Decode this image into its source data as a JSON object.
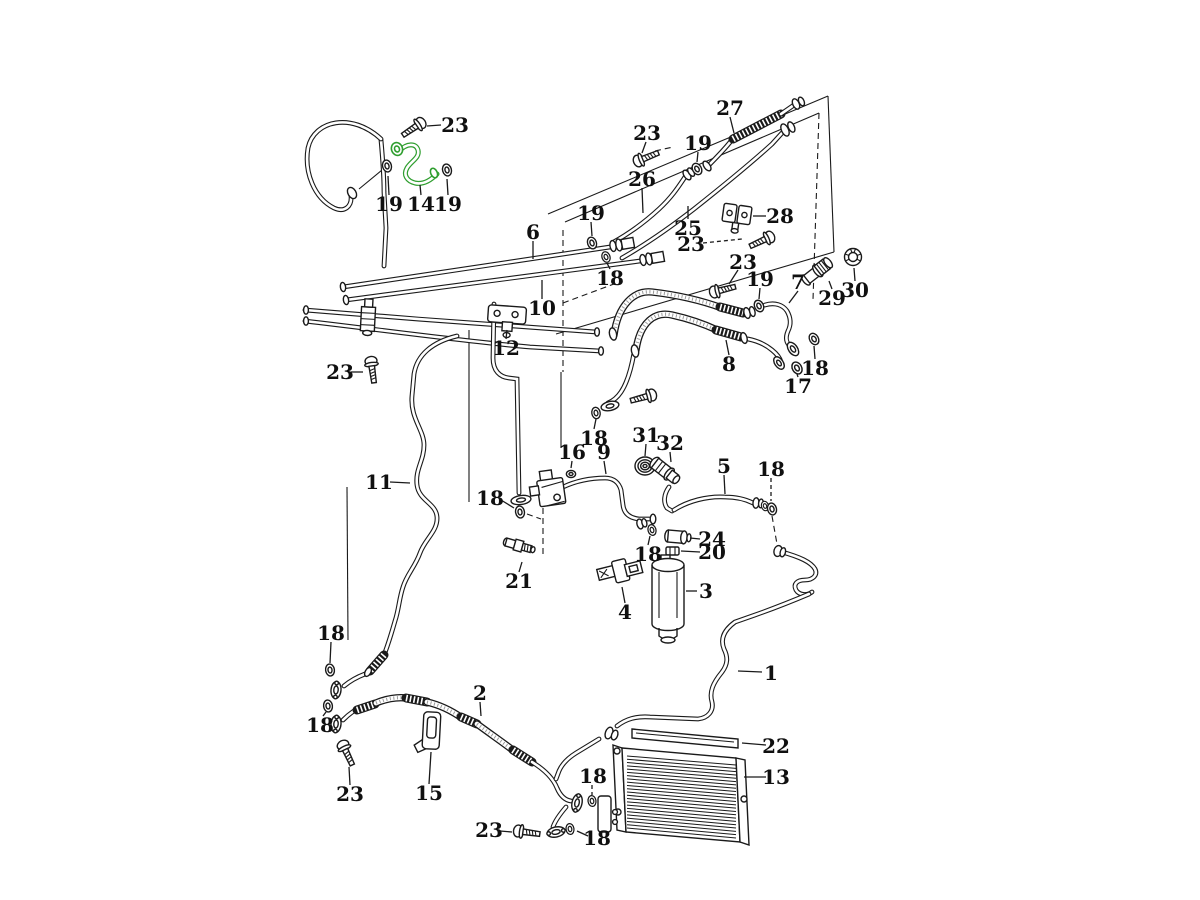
{
  "diagram": {
    "type": "exploded-parts-diagram",
    "subject": "air-conditioning-lines-and-condenser",
    "colors": {
      "background": "#ffffff",
      "line": "#1a1a1a",
      "highlight": "#2f9e2f"
    },
    "highlighted_part_number": "14",
    "condenser_fins": 23,
    "part_numbers_visible": [
      "1",
      "2",
      "3",
      "4",
      "5",
      "6",
      "7",
      "8",
      "9",
      "10",
      "11",
      "12",
      "13",
      "14",
      "15",
      "16",
      "17",
      "18",
      "19",
      "20",
      "21",
      "22",
      "23",
      "24",
      "25",
      "26",
      "27",
      "28",
      "29",
      "30",
      "31",
      "32"
    ],
    "part_labels": [
      {
        "text": "23",
        "x": 455,
        "y": 125,
        "leader": {
          "x1": 441,
          "y1": 125,
          "x2": 427,
          "y2": 126
        }
      },
      {
        "text": "19",
        "x": 389,
        "y": 204,
        "leader": {
          "x1": 389,
          "y1": 195,
          "x2": 388,
          "y2": 176
        }
      },
      {
        "text": "14",
        "x": 421,
        "y": 204,
        "leader": {
          "x1": 421,
          "y1": 195,
          "x2": 420,
          "y2": 185
        }
      },
      {
        "text": "19",
        "x": 448,
        "y": 204,
        "leader": {
          "x1": 448,
          "y1": 195,
          "x2": 447,
          "y2": 179
        }
      },
      {
        "text": "27",
        "x": 730,
        "y": 108,
        "leader": {
          "x1": 730,
          "y1": 117,
          "x2": 734,
          "y2": 133
        }
      },
      {
        "text": "23",
        "x": 647,
        "y": 133,
        "leader": {
          "x1": 646,
          "y1": 142,
          "x2": 642,
          "y2": 153
        }
      },
      {
        "text": "19",
        "x": 698,
        "y": 143,
        "leader": {
          "x1": 698,
          "y1": 152,
          "x2": 697,
          "y2": 162
        }
      },
      {
        "text": "26",
        "x": 642,
        "y": 179,
        "leader": {
          "x1": 642,
          "y1": 188,
          "x2": 643,
          "y2": 213
        }
      },
      {
        "text": "6",
        "x": 533,
        "y": 232,
        "leader": {
          "x1": 533,
          "y1": 241,
          "x2": 533,
          "y2": 259
        }
      },
      {
        "text": "25",
        "x": 688,
        "y": 228,
        "leader": {
          "x1": 688,
          "y1": 219,
          "x2": 688,
          "y2": 206
        }
      },
      {
        "text": "28",
        "x": 780,
        "y": 216,
        "leader": {
          "x1": 766,
          "y1": 216,
          "x2": 753,
          "y2": 216
        }
      },
      {
        "text": "19",
        "x": 591,
        "y": 213,
        "leader": {
          "x1": 591,
          "y1": 222,
          "x2": 592,
          "y2": 236
        }
      },
      {
        "text": "18",
        "x": 610,
        "y": 278,
        "leader": {
          "x1": 610,
          "y1": 269,
          "x2": 607,
          "y2": 263
        }
      },
      {
        "text": "23",
        "x": 691,
        "y": 244,
        "dash": true,
        "leader": {
          "x1": 703,
          "y1": 243,
          "x2": 742,
          "y2": 239
        }
      },
      {
        "text": "10",
        "x": 542,
        "y": 308,
        "leader": {
          "x1": 542,
          "y1": 299,
          "x2": 542,
          "y2": 280
        }
      },
      {
        "text": "12",
        "x": 506,
        "y": 348,
        "leader": {
          "x1": 506,
          "y1": 339,
          "x2": 507,
          "y2": 330
        }
      },
      {
        "text": "23",
        "x": 340,
        "y": 372,
        "leader": {
          "x1": 351,
          "y1": 372,
          "x2": 363,
          "y2": 372
        }
      },
      {
        "text": "8",
        "x": 729,
        "y": 364,
        "leader": {
          "x1": 729,
          "y1": 355,
          "x2": 726,
          "y2": 340
        }
      },
      {
        "text": "17",
        "x": 798,
        "y": 386,
        "leader": {
          "x1": 798,
          "y1": 377,
          "x2": 797,
          "y2": 374
        }
      },
      {
        "text": "18",
        "x": 815,
        "y": 368,
        "leader": {
          "x1": 815,
          "y1": 359,
          "x2": 814,
          "y2": 346
        }
      },
      {
        "text": "19",
        "x": 760,
        "y": 279,
        "leader": {
          "x1": 760,
          "y1": 288,
          "x2": 759,
          "y2": 299
        }
      },
      {
        "text": "7",
        "x": 798,
        "y": 282,
        "leader": {
          "x1": 798,
          "y1": 291,
          "x2": 789,
          "y2": 303
        }
      },
      {
        "text": "23",
        "x": 743,
        "y": 262,
        "leader": {
          "x1": 738,
          "y1": 270,
          "x2": 729,
          "y2": 284
        }
      },
      {
        "text": "29",
        "x": 832,
        "y": 298,
        "leader": {
          "x1": 832,
          "y1": 289,
          "x2": 829,
          "y2": 281
        }
      },
      {
        "text": "30",
        "x": 855,
        "y": 290,
        "leader": {
          "x1": 855,
          "y1": 281,
          "x2": 854,
          "y2": 268
        }
      },
      {
        "text": "18",
        "x": 331,
        "y": 633,
        "leader": {
          "x1": 331,
          "y1": 642,
          "x2": 330,
          "y2": 663
        }
      },
      {
        "text": "11",
        "x": 379,
        "y": 482,
        "leader": {
          "x1": 390,
          "y1": 482,
          "x2": 410,
          "y2": 483
        }
      },
      {
        "text": "18",
        "x": 490,
        "y": 498,
        "leader": {
          "x1": 501,
          "y1": 500,
          "x2": 514,
          "y2": 508
        }
      },
      {
        "text": "16",
        "x": 572,
        "y": 452,
        "leader": {
          "x1": 572,
          "y1": 461,
          "x2": 571,
          "y2": 468
        }
      },
      {
        "text": "9",
        "x": 604,
        "y": 452,
        "leader": {
          "x1": 604,
          "y1": 461,
          "x2": 606,
          "y2": 474
        }
      },
      {
        "text": "18",
        "x": 594,
        "y": 438,
        "leader": {
          "x1": 594,
          "y1": 429,
          "x2": 596,
          "y2": 419
        }
      },
      {
        "text": "31",
        "x": 646,
        "y": 435,
        "leader": {
          "x1": 646,
          "y1": 444,
          "x2": 645,
          "y2": 456
        }
      },
      {
        "text": "32",
        "x": 670,
        "y": 443,
        "leader": {
          "x1": 670,
          "y1": 452,
          "x2": 671,
          "y2": 462
        }
      },
      {
        "text": "5",
        "x": 724,
        "y": 466,
        "leader": {
          "x1": 724,
          "y1": 475,
          "x2": 725,
          "y2": 494
        }
      },
      {
        "text": "18",
        "x": 771,
        "y": 469,
        "dash": true,
        "leader": {
          "x1": 771,
          "y1": 478,
          "x2": 771,
          "y2": 501
        }
      },
      {
        "text": "24",
        "x": 712,
        "y": 539,
        "leader": {
          "x1": 700,
          "y1": 539,
          "x2": 690,
          "y2": 538
        }
      },
      {
        "text": "20",
        "x": 712,
        "y": 552,
        "leader": {
          "x1": 700,
          "y1": 552,
          "x2": 681,
          "y2": 551
        }
      },
      {
        "text": "18",
        "x": 648,
        "y": 554,
        "leader": {
          "x1": 648,
          "y1": 545,
          "x2": 650,
          "y2": 536
        }
      },
      {
        "text": "3",
        "x": 706,
        "y": 591,
        "leader": {
          "x1": 697,
          "y1": 591,
          "x2": 686,
          "y2": 591
        }
      },
      {
        "text": "4",
        "x": 625,
        "y": 612,
        "leader": {
          "x1": 625,
          "y1": 603,
          "x2": 622,
          "y2": 587
        }
      },
      {
        "text": "21",
        "x": 519,
        "y": 581,
        "leader": {
          "x1": 519,
          "y1": 572,
          "x2": 522,
          "y2": 562
        }
      },
      {
        "text": "18",
        "x": 320,
        "y": 725,
        "leader": {
          "x1": 323,
          "y1": 716,
          "x2": 326,
          "y2": 712
        }
      },
      {
        "text": "23",
        "x": 350,
        "y": 794,
        "leader": {
          "x1": 350,
          "y1": 785,
          "x2": 349,
          "y2": 767
        }
      },
      {
        "text": "2",
        "x": 480,
        "y": 693,
        "leader": {
          "x1": 480,
          "y1": 702,
          "x2": 481,
          "y2": 716
        }
      },
      {
        "text": "15",
        "x": 429,
        "y": 793,
        "leader": {
          "x1": 429,
          "y1": 784,
          "x2": 431,
          "y2": 752
        }
      },
      {
        "text": "23",
        "x": 489,
        "y": 830,
        "leader": {
          "x1": 500,
          "y1": 831,
          "x2": 512,
          "y2": 832
        }
      },
      {
        "text": "18",
        "x": 593,
        "y": 776,
        "dash": true,
        "leader": {
          "x1": 592,
          "y1": 785,
          "x2": 592,
          "y2": 795
        }
      },
      {
        "text": "18",
        "x": 597,
        "y": 838,
        "leader": {
          "x1": 588,
          "y1": 836,
          "x2": 577,
          "y2": 831
        }
      },
      {
        "text": "1",
        "x": 771,
        "y": 673,
        "leader": {
          "x1": 762,
          "y1": 672,
          "x2": 738,
          "y2": 671
        }
      },
      {
        "text": "22",
        "x": 776,
        "y": 746,
        "leader": {
          "x1": 766,
          "y1": 745,
          "x2": 742,
          "y2": 743
        }
      },
      {
        "text": "13",
        "x": 776,
        "y": 777,
        "leader": {
          "x1": 766,
          "y1": 777,
          "x2": 744,
          "y2": 777
        }
      }
    ]
  }
}
